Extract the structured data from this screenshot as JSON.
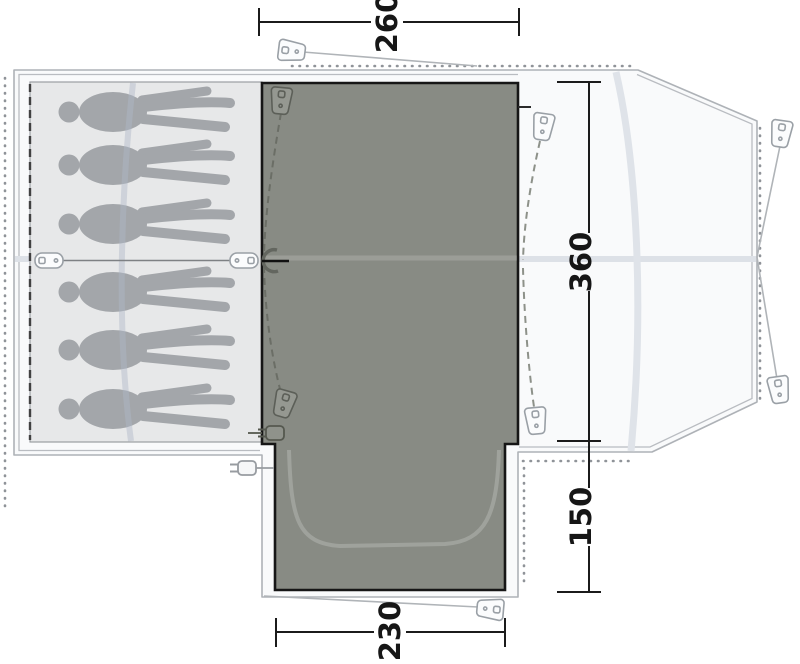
{
  "diagram": {
    "type": "tent-floorplan-top-view",
    "dimensions": {
      "front_width": {
        "value": "260",
        "position": "top"
      },
      "main_depth": {
        "value": "360",
        "position": "right-upper"
      },
      "porch_depth": {
        "value": "150",
        "position": "right-lower"
      },
      "porch_width": {
        "value": "230",
        "position": "bottom"
      }
    },
    "sleeping_area": {
      "capacity": 6,
      "has_divider": true
    },
    "icons": {
      "peg": "guy-line-peg",
      "plug": "cable-entry-point",
      "zipper": "door-zipper-pull",
      "toggle": "divider-toggle",
      "person": "sleeping-person-silhouette"
    },
    "colors": {
      "groundsheet": "#888b84",
      "bedroom": "#e7e8e9",
      "silhouette": "#a3a6aa",
      "tent_fill": "#f9fafb",
      "outline": "#aeb2b7",
      "dimension": "#1b1b1b"
    }
  }
}
